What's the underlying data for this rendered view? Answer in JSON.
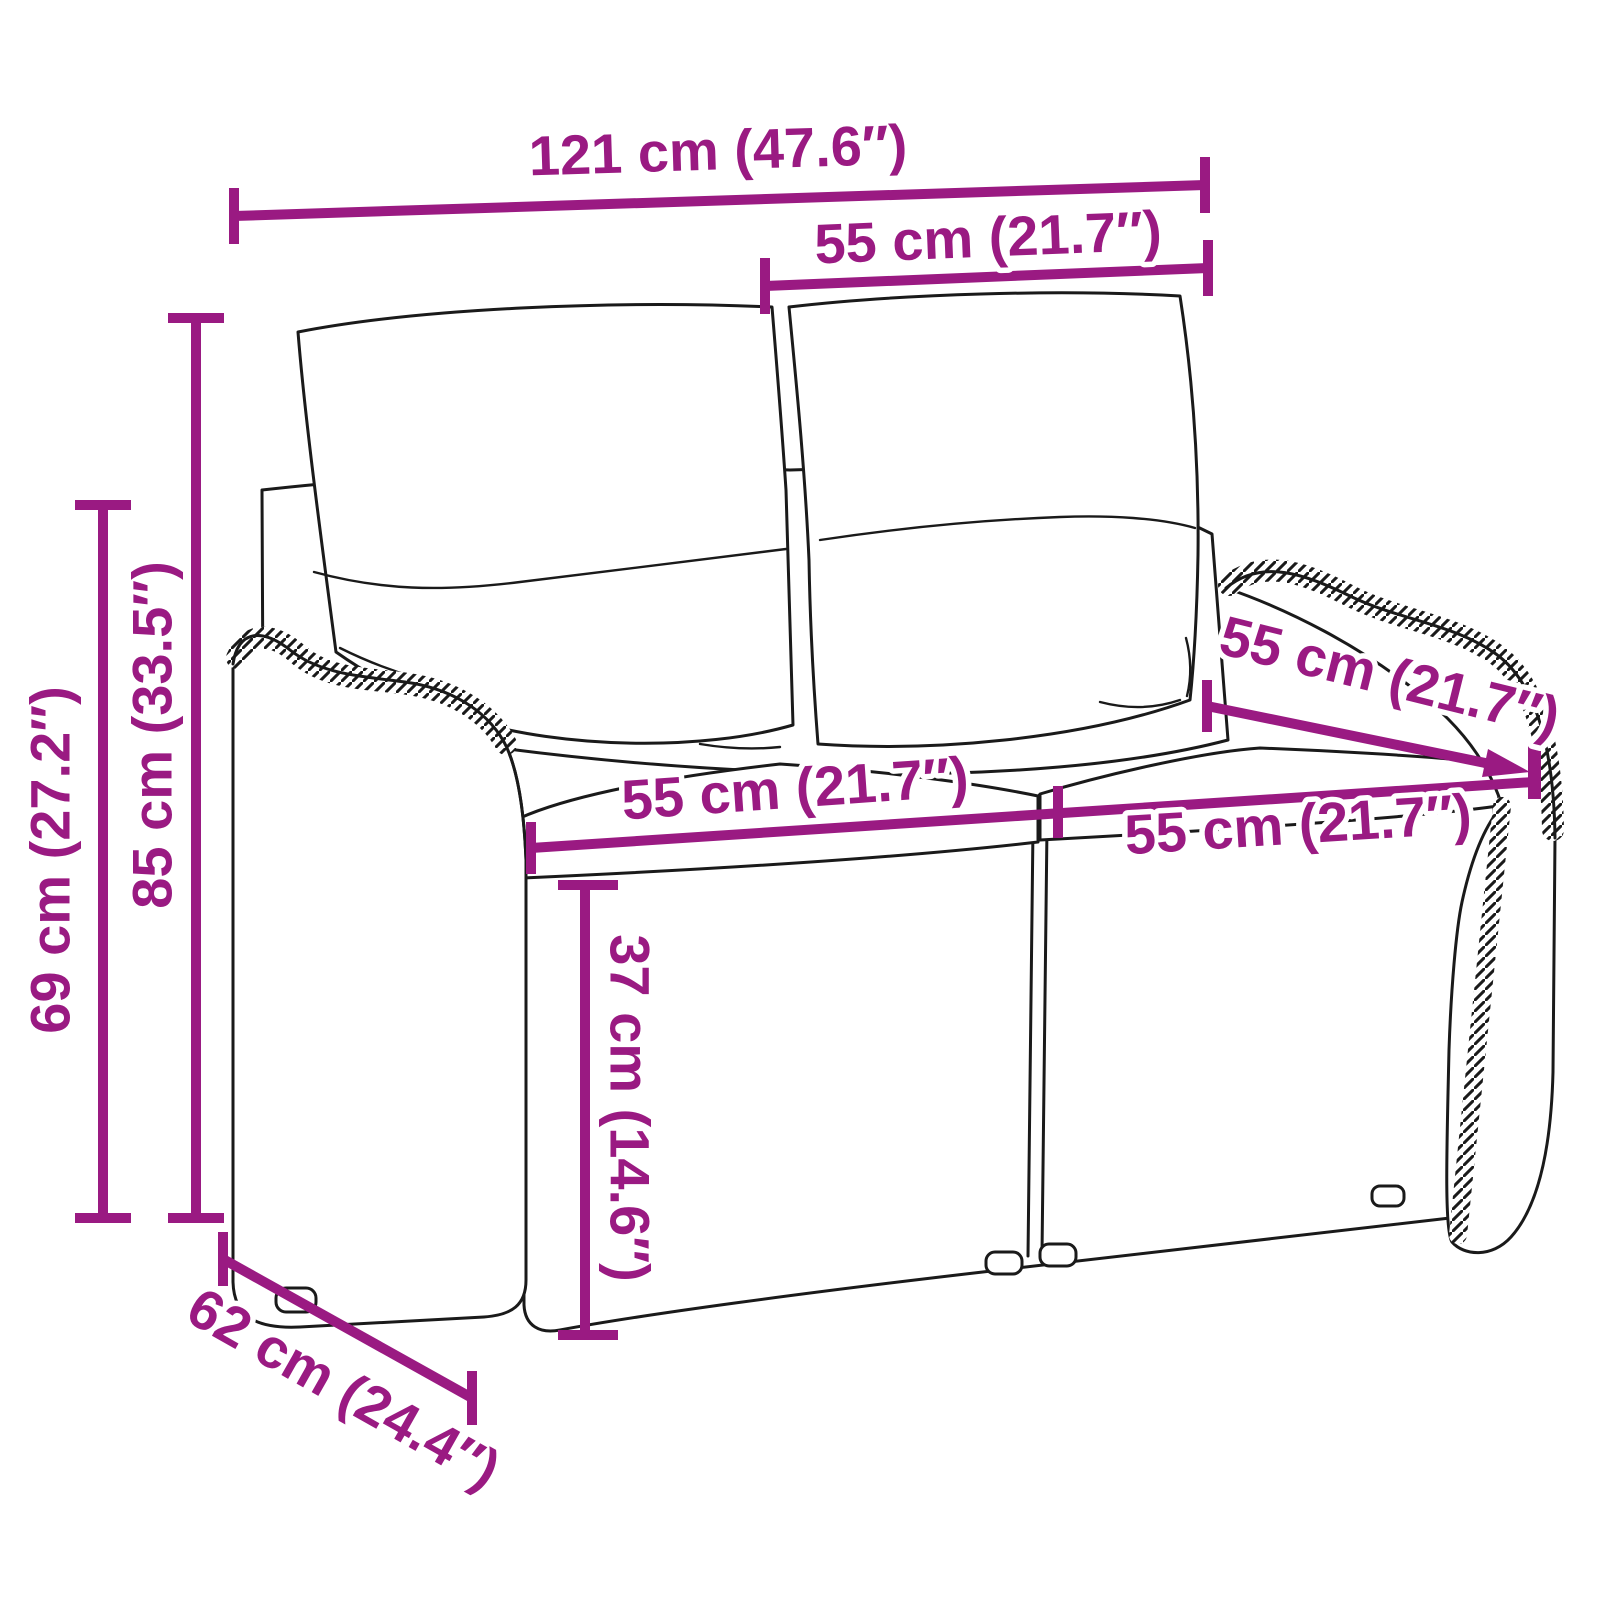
{
  "diagram": {
    "product": "Rattan garden bench with back and seat cushions (2-seater), line drawing with dimension callouts",
    "style": {
      "dimension_color": "#9A1A82",
      "line_art_color": "#1a1a1a",
      "background": "#ffffff"
    },
    "dimensions": [
      {
        "id": "overall-width",
        "label": "121 cm (47.6″)",
        "orientation": "horizontal"
      },
      {
        "id": "backrest-cushion-width",
        "label": "55 cm (21.7″)",
        "orientation": "horizontal"
      },
      {
        "id": "total-height",
        "label": "85 cm (33.5″)",
        "orientation": "vertical"
      },
      {
        "id": "armrest-height",
        "label": "69 cm (27.2″)",
        "orientation": "vertical"
      },
      {
        "id": "seat-width-left",
        "label": "55 cm (21.7″)",
        "orientation": "horizontal"
      },
      {
        "id": "seat-width-right",
        "label": "55 cm (21.7″)",
        "orientation": "horizontal"
      },
      {
        "id": "seat-depth",
        "label": "55 cm (21.7″)",
        "orientation": "diagonal"
      },
      {
        "id": "seat-height",
        "label": "37 cm (14.6″)",
        "orientation": "vertical"
      },
      {
        "id": "base-depth",
        "label": "62 cm (24.4″)",
        "orientation": "diagonal"
      }
    ]
  }
}
